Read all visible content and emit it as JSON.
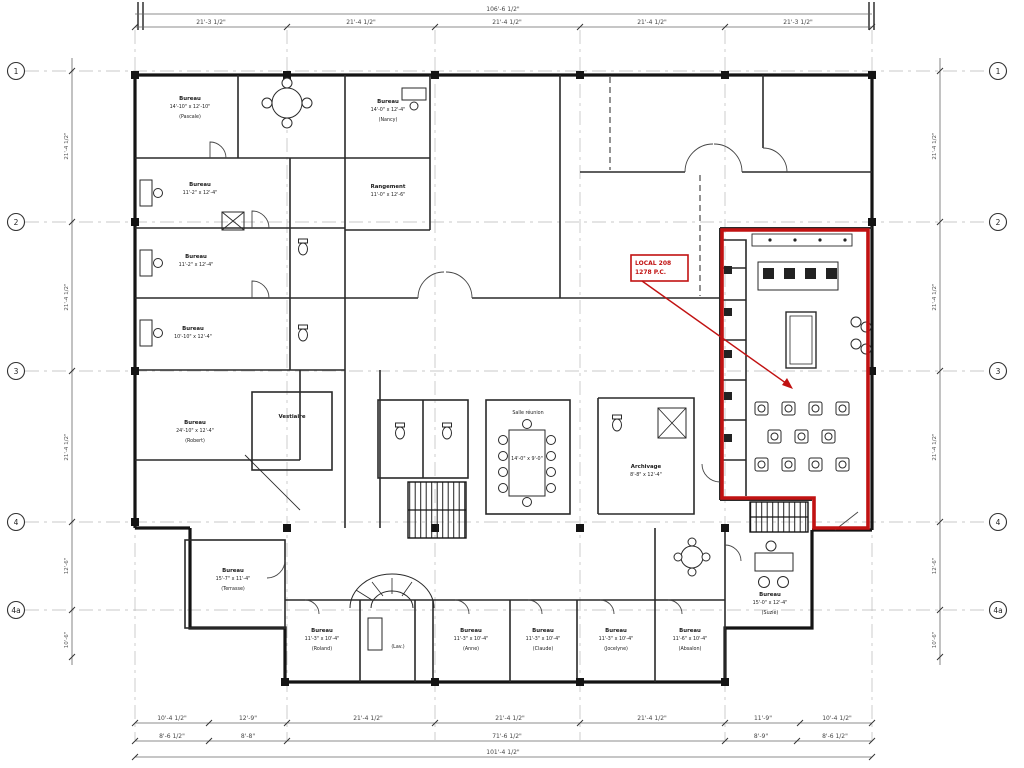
{
  "drawing": {
    "type": "architectural-floor-plan",
    "colors": {
      "highlight_red": "#c11212",
      "wall_black": "#141414",
      "background": "#ffffff"
    }
  },
  "annotation": {
    "title": "LOCAL 208",
    "area": "1278 P.C."
  },
  "grid": {
    "rows": [
      "1",
      "2",
      "3",
      "4",
      "4a"
    ]
  },
  "dims": {
    "top_overall": "106'-6 1/2\"",
    "top_bays": [
      "21'-3 1/2\"",
      "21'-4 1/2\"",
      "21'-4 1/2\"",
      "21'-4 1/2\"",
      "21'-3 1/2\""
    ],
    "bottom_row1": [
      "10'-4 1/2\"",
      "12'-9\"",
      "21'-4 1/2\"",
      "21'-4 1/2\"",
      "21'-4 1/2\"",
      "11'-9\"",
      "10'-4 1/2\""
    ],
    "bottom_row2": [
      "8'-6 1/2\"",
      "8'-8\"",
      "71'-6 1/2\"",
      "8'-9\"",
      "8'-6 1/2\""
    ],
    "bottom_total": "101'-4 1/2\"",
    "left_stack": [
      "21'-4 1/2\"",
      "21'-4 1/2\"",
      "21'-4 1/2\"",
      "12'-6\"",
      "10'-6\""
    ],
    "right_stack": [
      "21'-4 1/2\"",
      "21'-4 1/2\"",
      "21'-4 1/2\"",
      "12'-6\"",
      "10'-6\""
    ]
  },
  "rooms": {
    "b1": {
      "name": "Bureau",
      "size": "14'-10\" x 12'-10\"",
      "occ": "(Pascale)"
    },
    "b2": {
      "name": "Bureau",
      "size": "14'-0\" x 12'-4\"",
      "occ": "(Nancy)"
    },
    "b3": {
      "name": "Bureau",
      "size": "11'-2\" x 12'-4\"",
      "occ": ""
    },
    "b4": {
      "name": "Bureau",
      "size": "11'-2\" x 12'-4\"",
      "occ": ""
    },
    "b5": {
      "name": "Bureau",
      "size": "10'-10\" x 12'-4\"",
      "occ": ""
    },
    "rang": {
      "name": "Rangement",
      "size": "11'-0\" x 12'-6\"",
      "occ": ""
    },
    "rob": {
      "name": "Bureau",
      "size": "24'-10\" x 12'-4\"",
      "occ": "(Robert)"
    },
    "vest": {
      "name": "Vestiaire",
      "size": "",
      "occ": ""
    },
    "conf": {
      "name": "Salle réunion",
      "size": "14'-0\" x 9'-0\"",
      "occ": ""
    },
    "arch": {
      "name": "Archivage",
      "size": "8'-8\" x 12'-4\"",
      "occ": ""
    },
    "terr": {
      "name": "Bureau",
      "size": "15'-7\" x 11'-4\"",
      "occ": "(Terrasse)"
    },
    "o1": {
      "name": "Bureau",
      "size": "11'-3\" x 10'-4\"",
      "occ": "(Roland)"
    },
    "lav": {
      "name": "(Lav.)",
      "size": "",
      "occ": ""
    },
    "o2": {
      "name": "Bureau",
      "size": "11'-3\" x 10'-4\"",
      "occ": "(Anne)"
    },
    "o3": {
      "name": "Bureau",
      "size": "11'-3\" x 10'-4\"",
      "occ": "(Claude)"
    },
    "o4": {
      "name": "Bureau",
      "size": "11'-3\" x 10'-4\"",
      "occ": "(Jocelyne)"
    },
    "o5": {
      "name": "Bureau",
      "size": "11'-6\" x 10'-4\"",
      "occ": "(Absalon)"
    },
    "suz": {
      "name": "Bureau",
      "size": "15'-0\" x 12'-4\"",
      "occ": "(Suzie)"
    }
  }
}
